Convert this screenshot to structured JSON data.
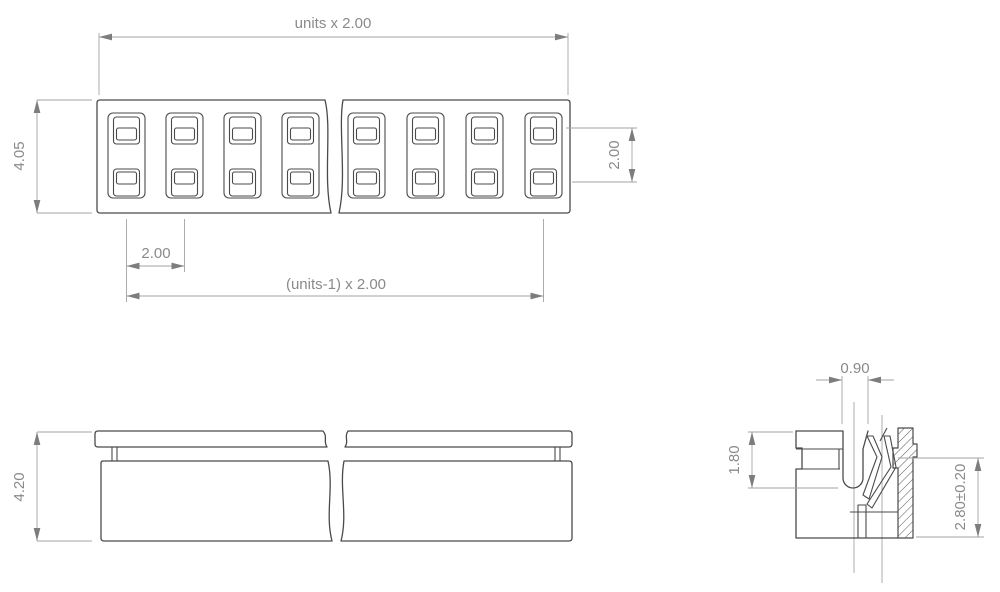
{
  "top_view": {
    "total_width_label": "units x 2.00",
    "body_height_label": "4.05",
    "pin_pitch_label": "2.00",
    "span_label": "(units-1) x 2.00",
    "row_pitch_label": "2.00"
  },
  "front_view": {
    "height_label": "4.20"
  },
  "section_view": {
    "slot_width_label": "0.90",
    "cap_height_label": "1.80",
    "contact_point_height_label": "2.80±0.20"
  },
  "colors": {
    "background": "#ffffff",
    "outline": "#4a4a4a",
    "dimension_line": "#a3a3a3",
    "dimension_text": "#8a8a8a"
  }
}
